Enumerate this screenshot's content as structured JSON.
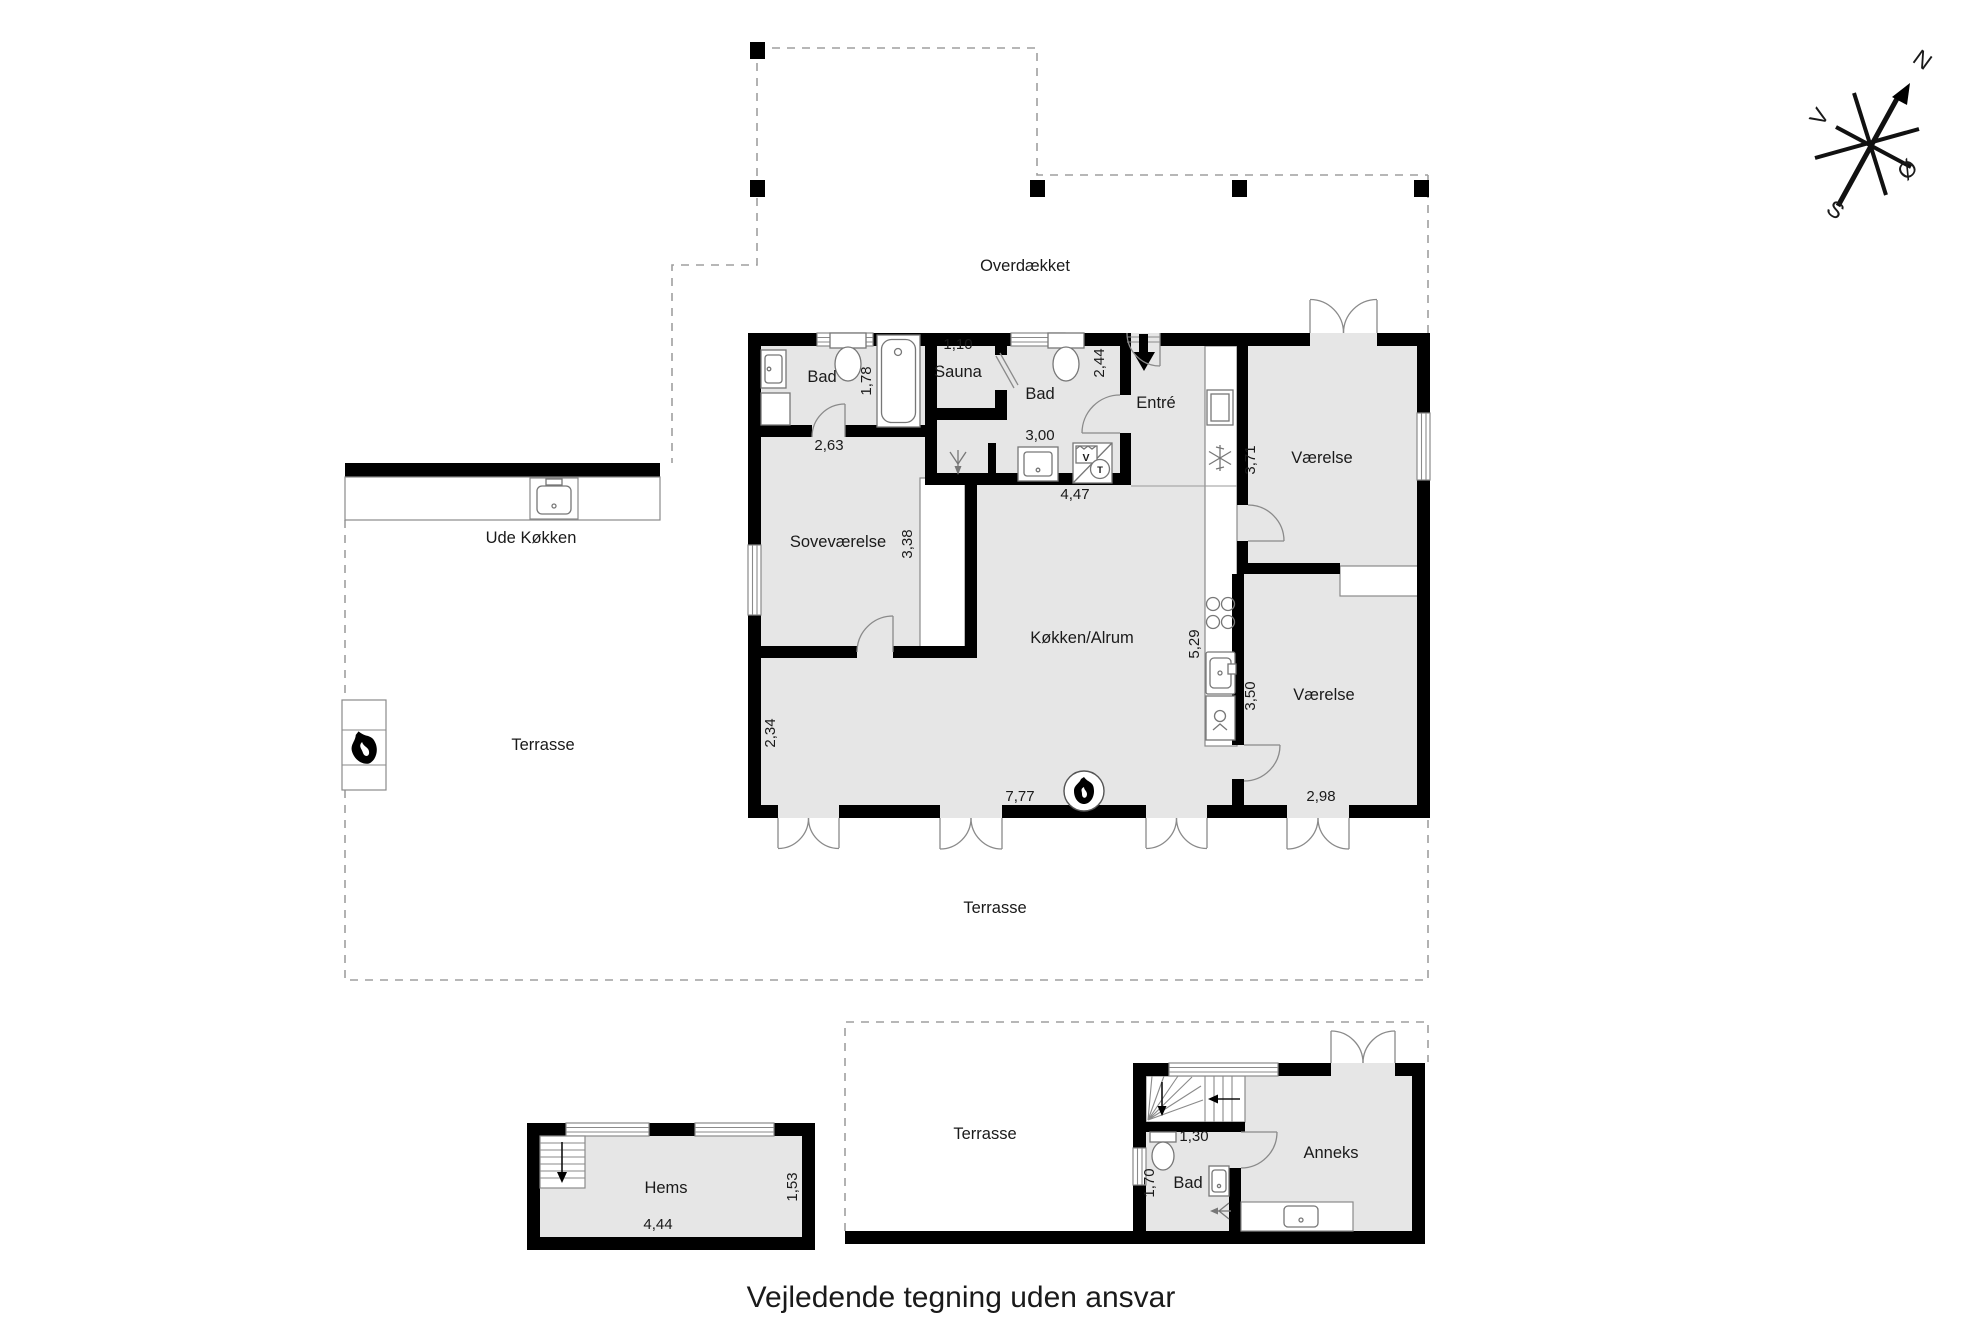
{
  "caption": "Vejledende tegning uden ansvar",
  "compass": {
    "north": "N",
    "south": "S",
    "west": "V",
    "east": "Ø"
  },
  "outdoor": {
    "overdaekket": "Overdækket",
    "ude_koekken": "Ude Køkken",
    "terrasse_west": "Terrasse",
    "terrasse_south": "Terrasse",
    "terrasse_anneks": "Terrasse"
  },
  "main": {
    "rooms": {
      "bad_nw": "Bad",
      "sauna": "Sauna",
      "bad_n": "Bad",
      "entre": "Entré",
      "vaerelse_ne": "Værelse",
      "sovevaerelse": "Soveværelse",
      "koekken_alrum": "Køkken/Alrum",
      "vaerelse_se": "Værelse"
    },
    "dims": {
      "sauna_width": "1,10",
      "bad_nw_depth": "1,78",
      "entre_depth": "2,44",
      "bad_nw_width": "2,63",
      "bad_n_width": "3,00",
      "hall_width": "4,47",
      "vaerelse_ne_depth": "3,71",
      "sovevaerelse_depth": "3,38",
      "koekken_depth": "5,29",
      "vaerelse_se_depth": "3,50",
      "stue_depth": "2,34",
      "koekken_width": "7,77",
      "vaerelse_se_width": "2,98"
    },
    "appliances": {
      "washing_machine": "V",
      "tumble_dryer": "T"
    }
  },
  "hems": {
    "label": "Hems",
    "width": "4,44",
    "depth": "1,53"
  },
  "anneks": {
    "label": "Anneks",
    "bad": "Bad",
    "bad_width": "1,30",
    "bad_depth": "1,70"
  }
}
